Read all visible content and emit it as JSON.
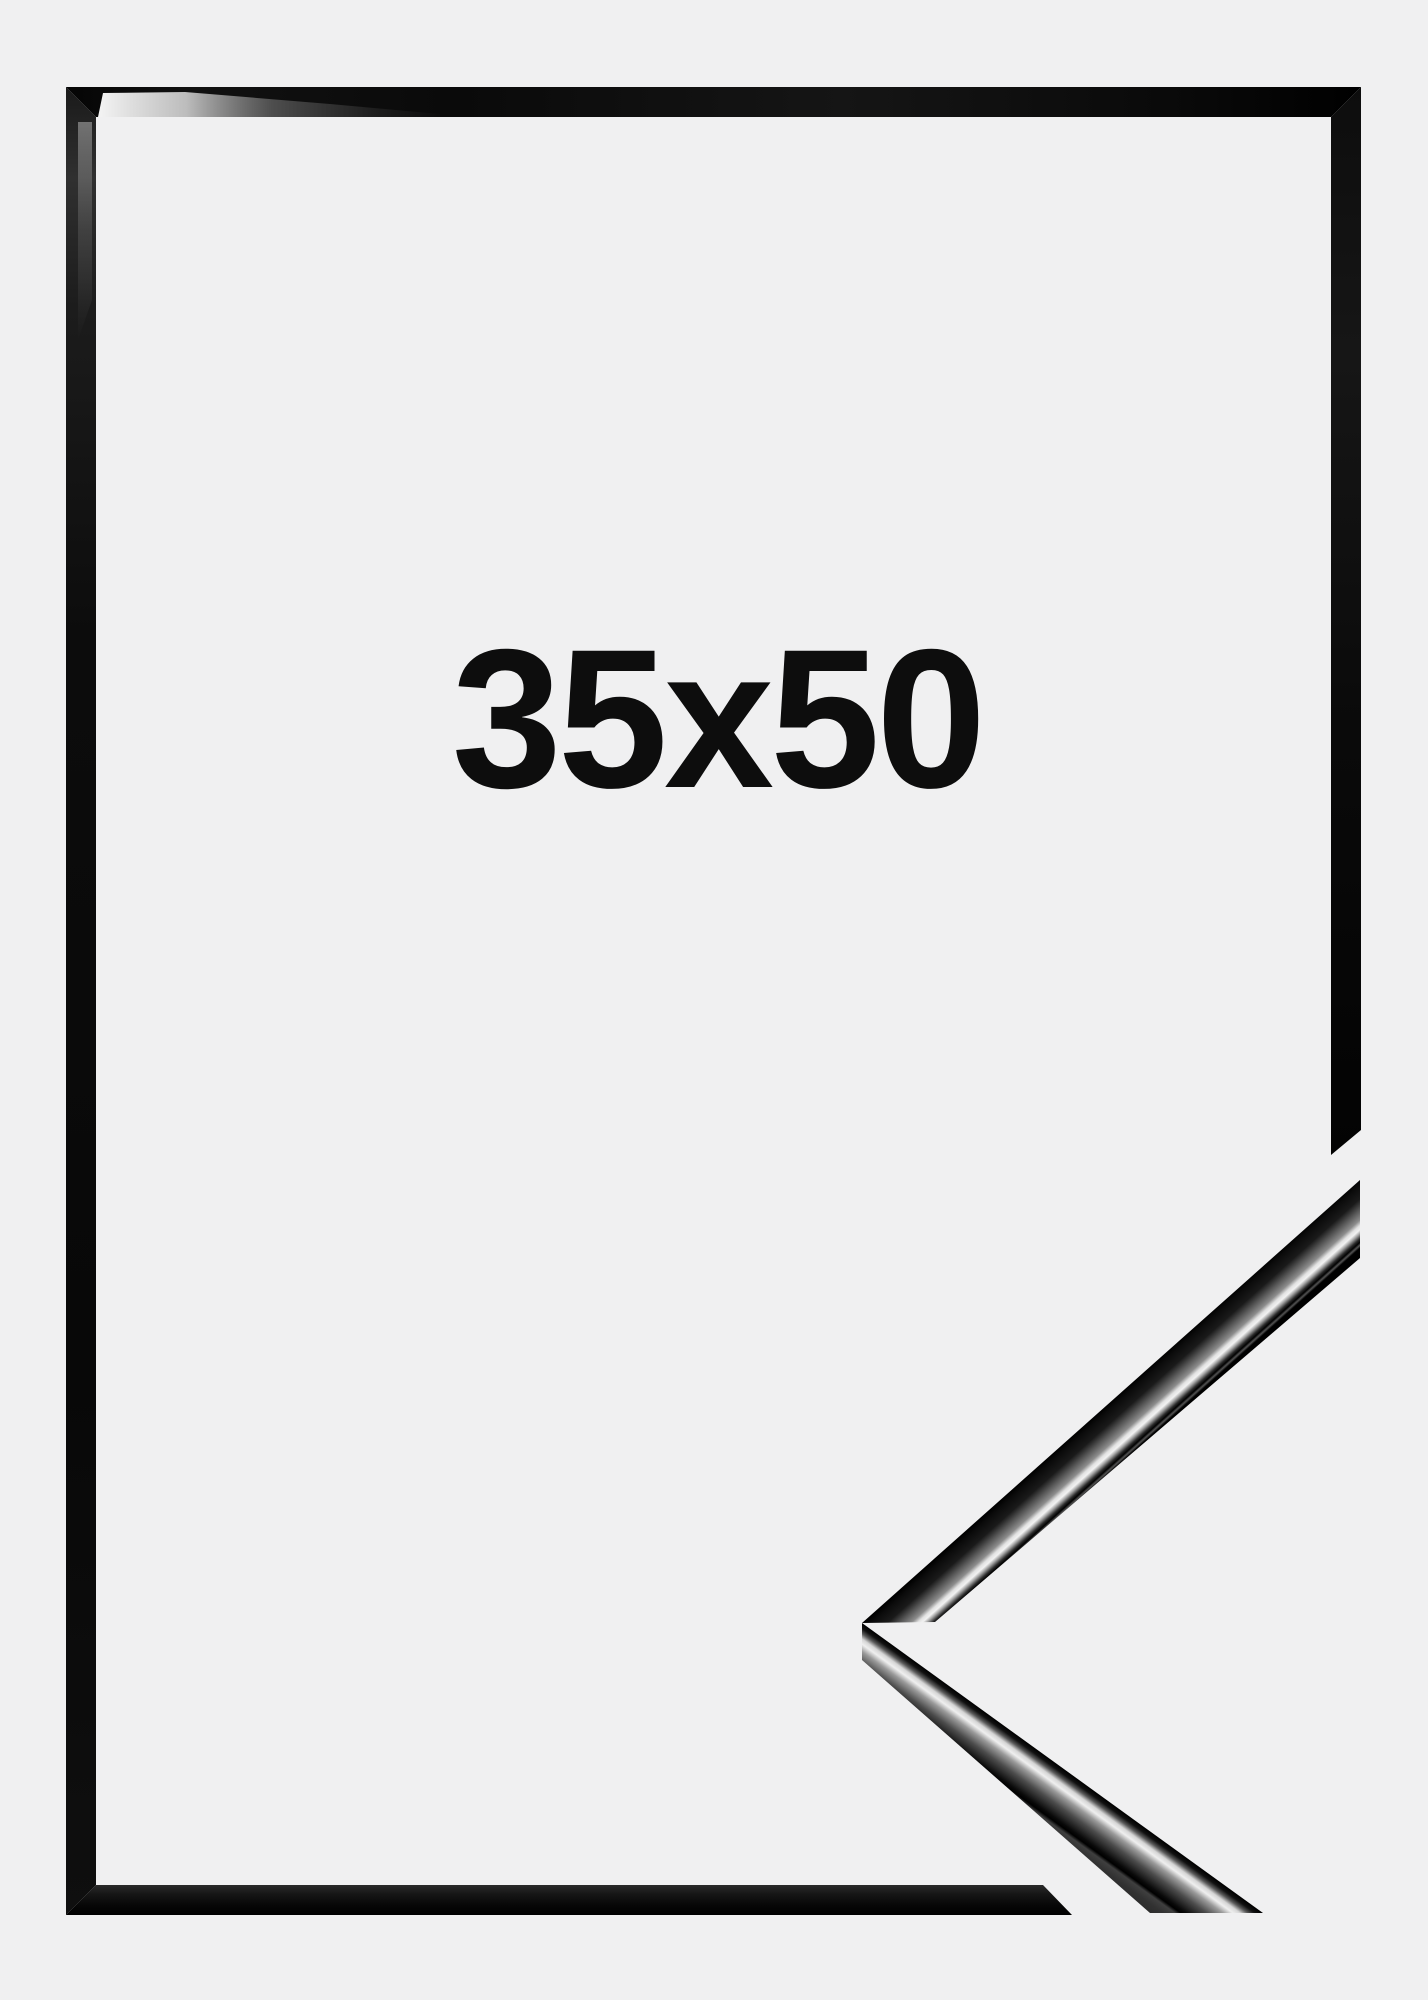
{
  "image": {
    "size_label": "35x50",
    "colors": {
      "background": "#f0f0f1",
      "frame_black": "#0a0a0a",
      "label_text": "#0d0d0d",
      "gloss_highlight": "#ffffff",
      "matte_side": "#2e2e2e"
    }
  }
}
